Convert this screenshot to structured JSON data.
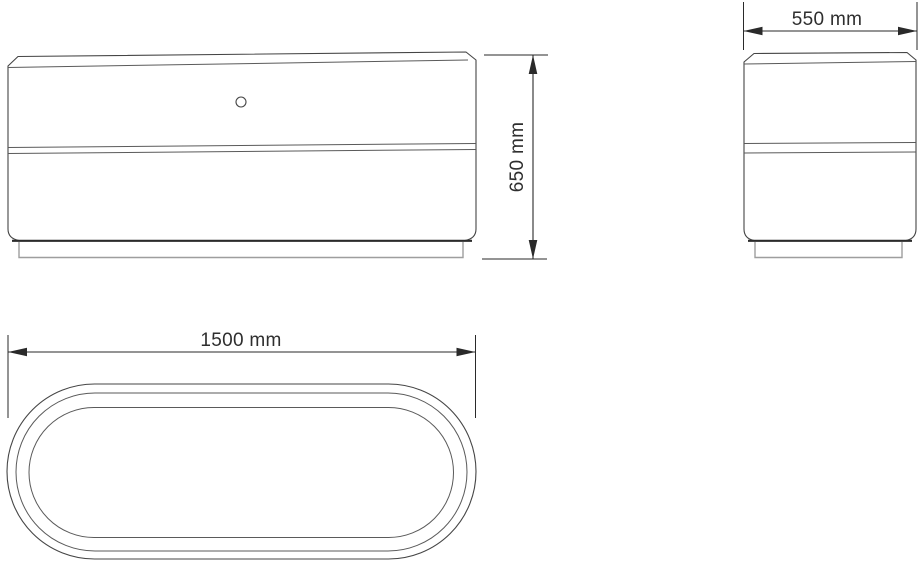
{
  "canvas": {
    "width": 922,
    "height": 562,
    "background": "#ffffff"
  },
  "drawing": {
    "colors": {
      "outline": "#454545",
      "heavy_edge": "#2b2b2b",
      "plinth": "#9e9e9e",
      "dimension": "#2a2a2a",
      "text": "#2e2e2e"
    },
    "views": {
      "front": {
        "id": "front-view"
      },
      "side": {
        "id": "side-view"
      },
      "top": {
        "id": "top-view"
      }
    },
    "dimensions": {
      "height": {
        "label": "650 mm",
        "orientation": "vertical"
      },
      "depth": {
        "label": "550 mm",
        "orientation": "horizontal"
      },
      "length": {
        "label": "1500 mm",
        "orientation": "horizontal"
      }
    }
  }
}
